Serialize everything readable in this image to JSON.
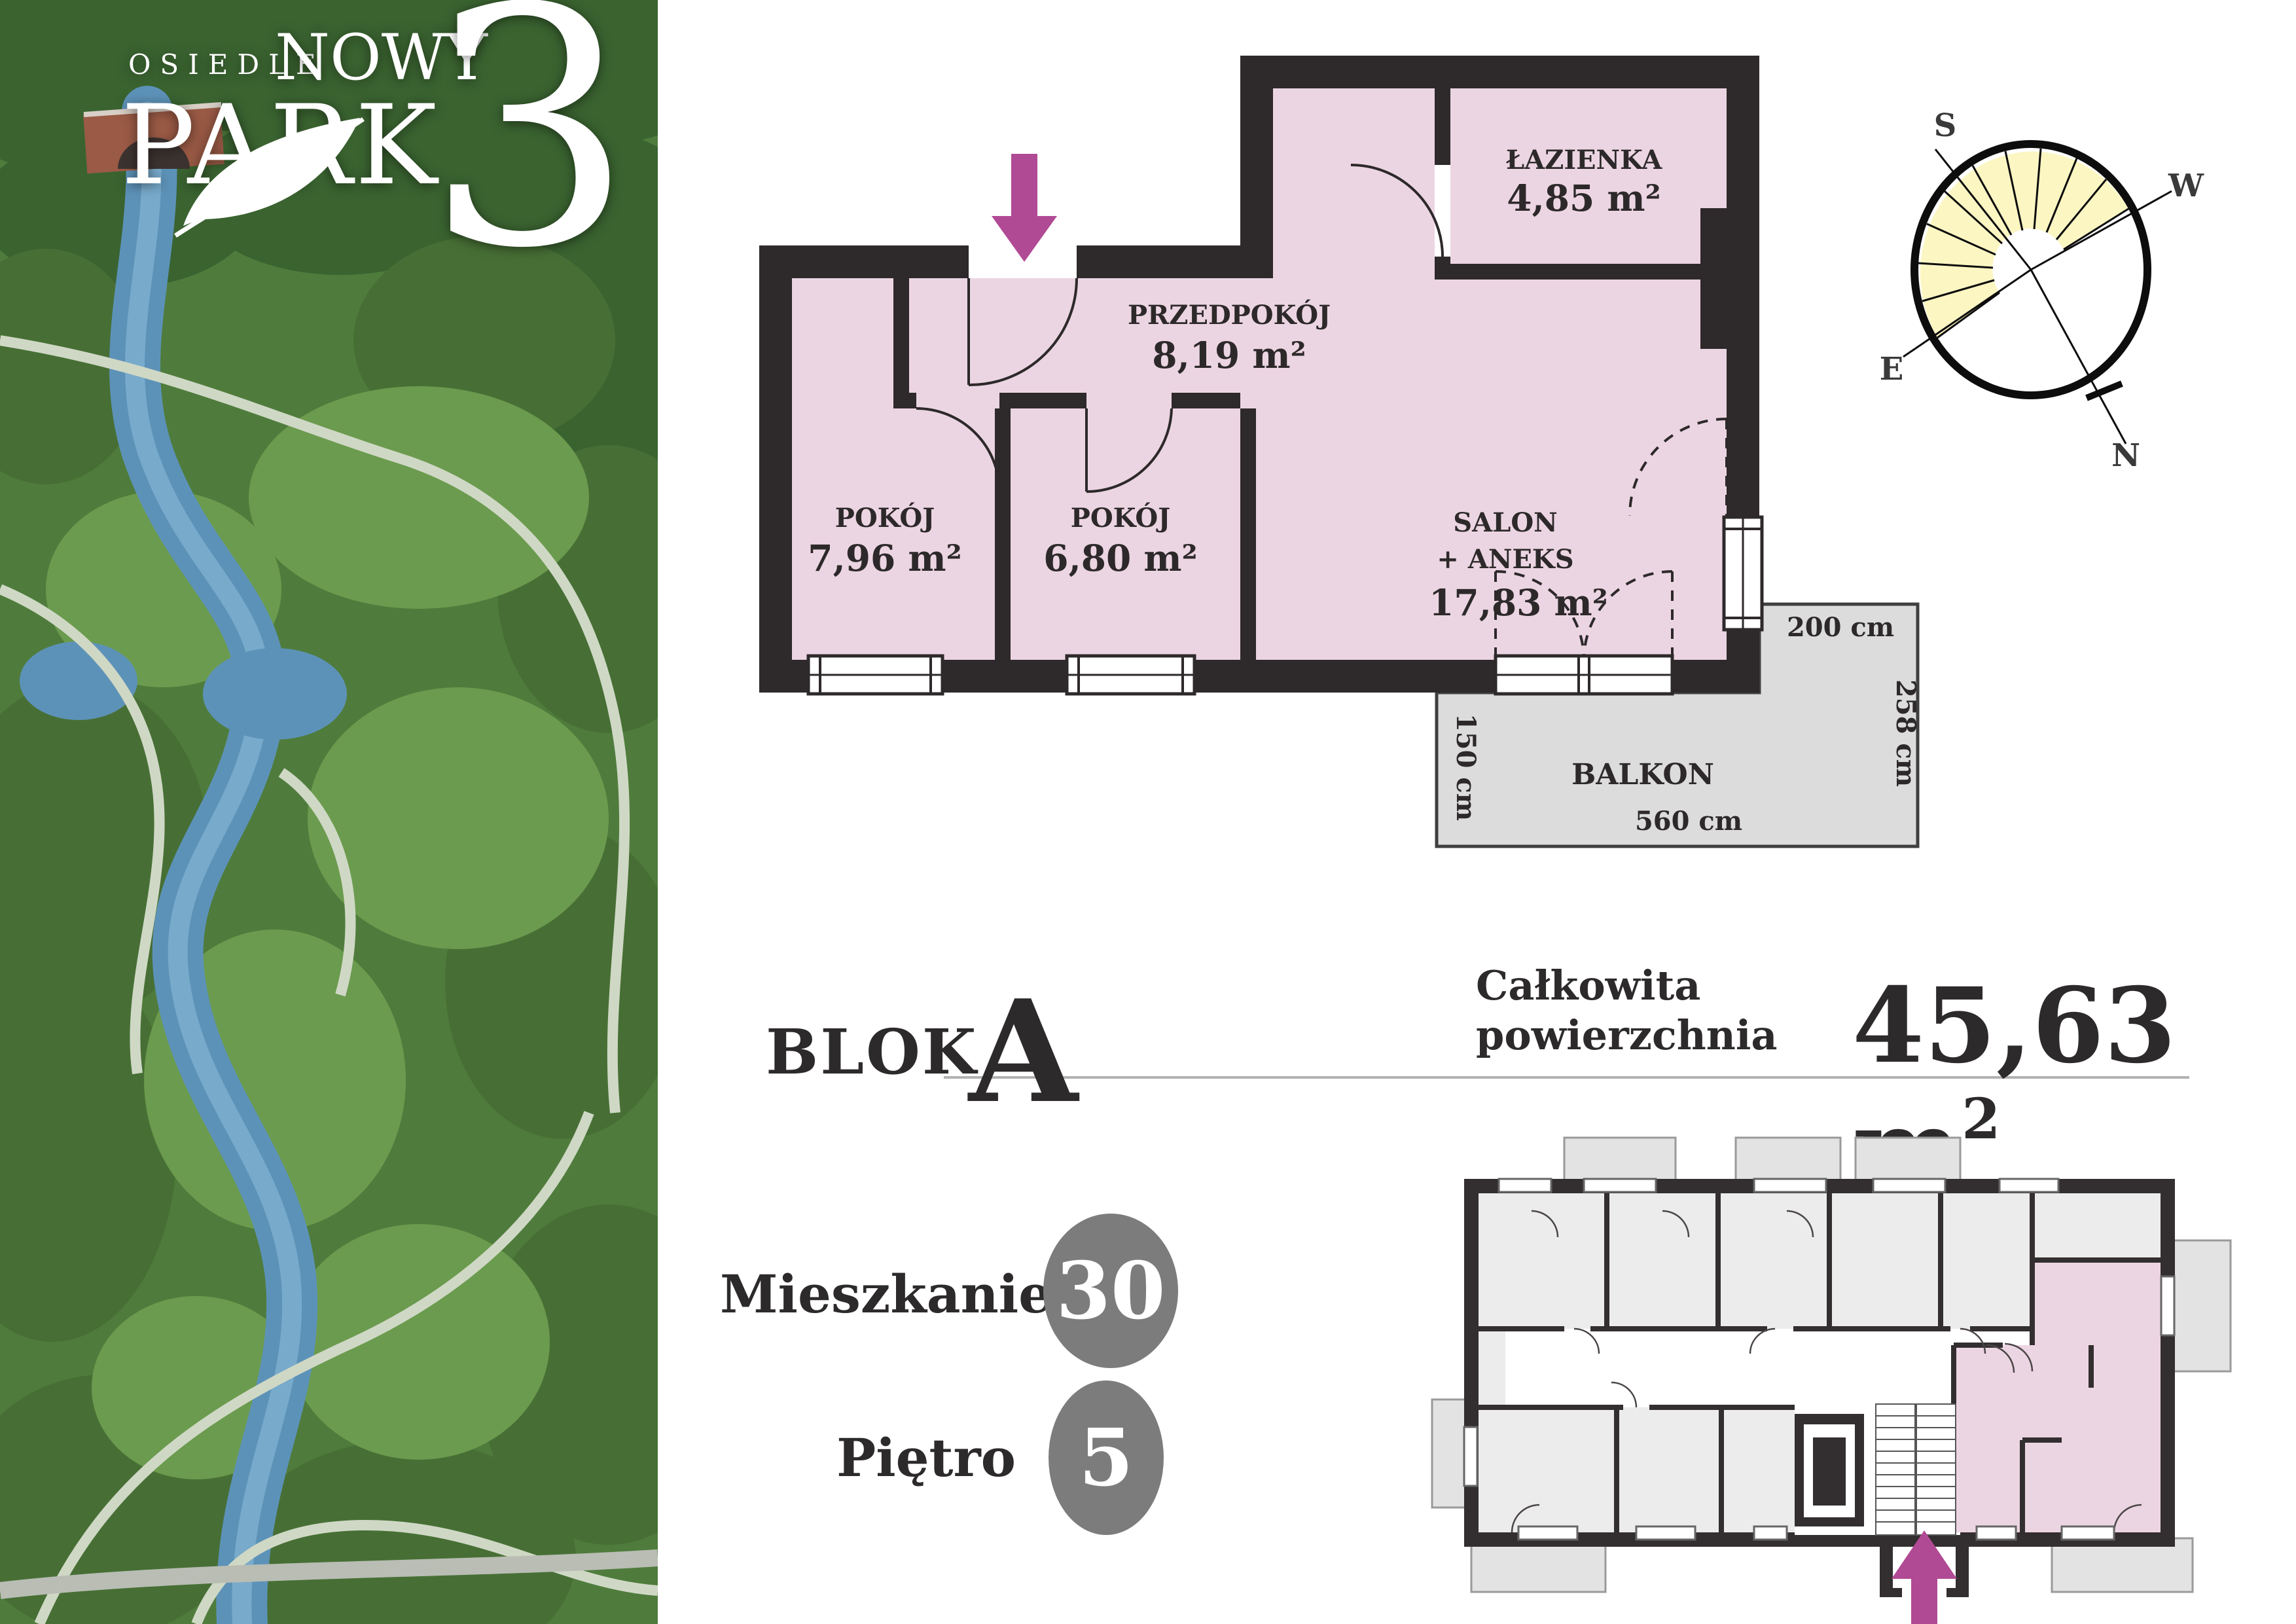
{
  "logo": {
    "osiedle": "OSIEDLE",
    "nowy": "NOWY",
    "park": "PARK",
    "three": "3"
  },
  "compass": {
    "s": "S",
    "w": "W",
    "e": "E",
    "n": "N"
  },
  "floorplan": {
    "rooms": {
      "lazienka": {
        "name": "ŁAZIENKA",
        "area": "4,85 m²"
      },
      "przedpokoj": {
        "name": "PRZEDPOKÓJ",
        "area": "8,19 m²"
      },
      "pokoj1": {
        "name": "POKÓJ",
        "area": "7,96 m²"
      },
      "pokoj2": {
        "name": "POKÓJ",
        "area": "6,80 m²"
      },
      "salon": {
        "name": "SALON",
        "name2": "+ ANEKS",
        "area": "17,83 m²"
      }
    },
    "balcony": {
      "label": "BALKON",
      "dim_top": "200 cm",
      "dim_right": "258 cm",
      "dim_left": "150 cm",
      "dim_bottom": "560 cm"
    }
  },
  "details": {
    "block_label": "BLOK",
    "block_value": "A",
    "total_label_line1": "Całkowita",
    "total_label_line2": "powierzchnia",
    "total_value_main": "45,63 m",
    "total_value_sup": "2",
    "apartment_label": "Mieszkanie",
    "apartment_value": "30",
    "floor_label": "Piętro",
    "floor_value": "5"
  },
  "colors": {
    "room_pink": "#ecd5e2",
    "wall_dark": "#2e292a",
    "balcony_gray": "#dcdcdc",
    "accent_magenta": "#b14a94",
    "badge_gray": "#7c7c7c",
    "compass_yellow": "#fcf6c3"
  }
}
